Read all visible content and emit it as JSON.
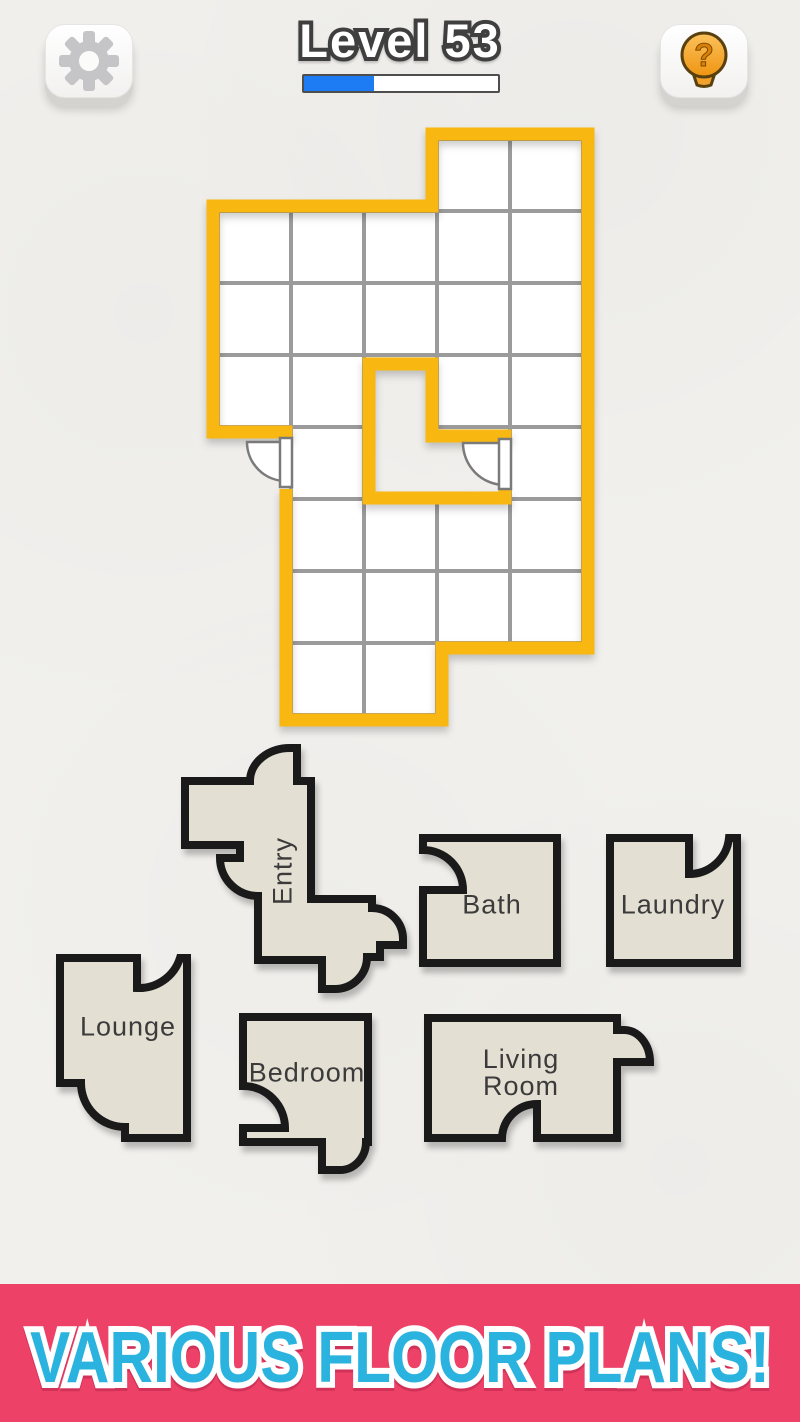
{
  "header": {
    "level_label": "Level 53",
    "progress_width": "36%",
    "settings_icon": "gear-icon",
    "hint_icon": "lightbulb-question-icon",
    "hint_glyph": "?"
  },
  "board": {
    "origin": [
      218,
      139
    ],
    "cell_size": [
      73,
      72
    ],
    "columns": 5,
    "rows": 8,
    "cells": [
      [
        4,
        1
      ],
      [
        5,
        1
      ],
      [
        1,
        2
      ],
      [
        2,
        2
      ],
      [
        3,
        2
      ],
      [
        4,
        2
      ],
      [
        5,
        2
      ],
      [
        1,
        3
      ],
      [
        2,
        3
      ],
      [
        3,
        3
      ],
      [
        4,
        3
      ],
      [
        5,
        3
      ],
      [
        1,
        4
      ],
      [
        2,
        4
      ],
      [
        4,
        4
      ],
      [
        5,
        4
      ],
      [
        2,
        5
      ],
      [
        5,
        5
      ],
      [
        2,
        6
      ],
      [
        3,
        6
      ],
      [
        4,
        6
      ],
      [
        5,
        6
      ],
      [
        2,
        7
      ],
      [
        3,
        7
      ],
      [
        4,
        7
      ],
      [
        5,
        7
      ],
      [
        2,
        8
      ],
      [
        3,
        8
      ]
    ],
    "doors": [
      "exterior-left-door",
      "courtyard-door"
    ]
  },
  "pieces": [
    {
      "id": "entry",
      "label": "Entry"
    },
    {
      "id": "bath",
      "label": "Bath"
    },
    {
      "id": "laundry",
      "label": "Laundry"
    },
    {
      "id": "lounge",
      "label": "Lounge"
    },
    {
      "id": "bedroom",
      "label": "Bedroom"
    },
    {
      "id": "living-room",
      "label": "Living Room"
    }
  ],
  "banner": {
    "text": "VARIOUS FLOOR PLANS!"
  },
  "colors": {
    "background": "#f1f0ed",
    "wall_yellow": "#f8b711",
    "grid_line": "#9b9b9b",
    "cell_fill": "#ffffff",
    "door_line": "#7a7a7a",
    "door_fill": "#ffffff",
    "piece_fill": "#e4dfd3",
    "piece_border": "#1a1a1a",
    "piece_label": "#3b3b3b",
    "title_fill": "#ffffff",
    "title_outline": "#3f3f3f",
    "progress_fill": "#1d7bf4",
    "gear_gray": "#c5c5c7",
    "banner_bg": "#ee4168",
    "banner_text": "#2bb3df",
    "banner_outline": "#ffffff"
  }
}
